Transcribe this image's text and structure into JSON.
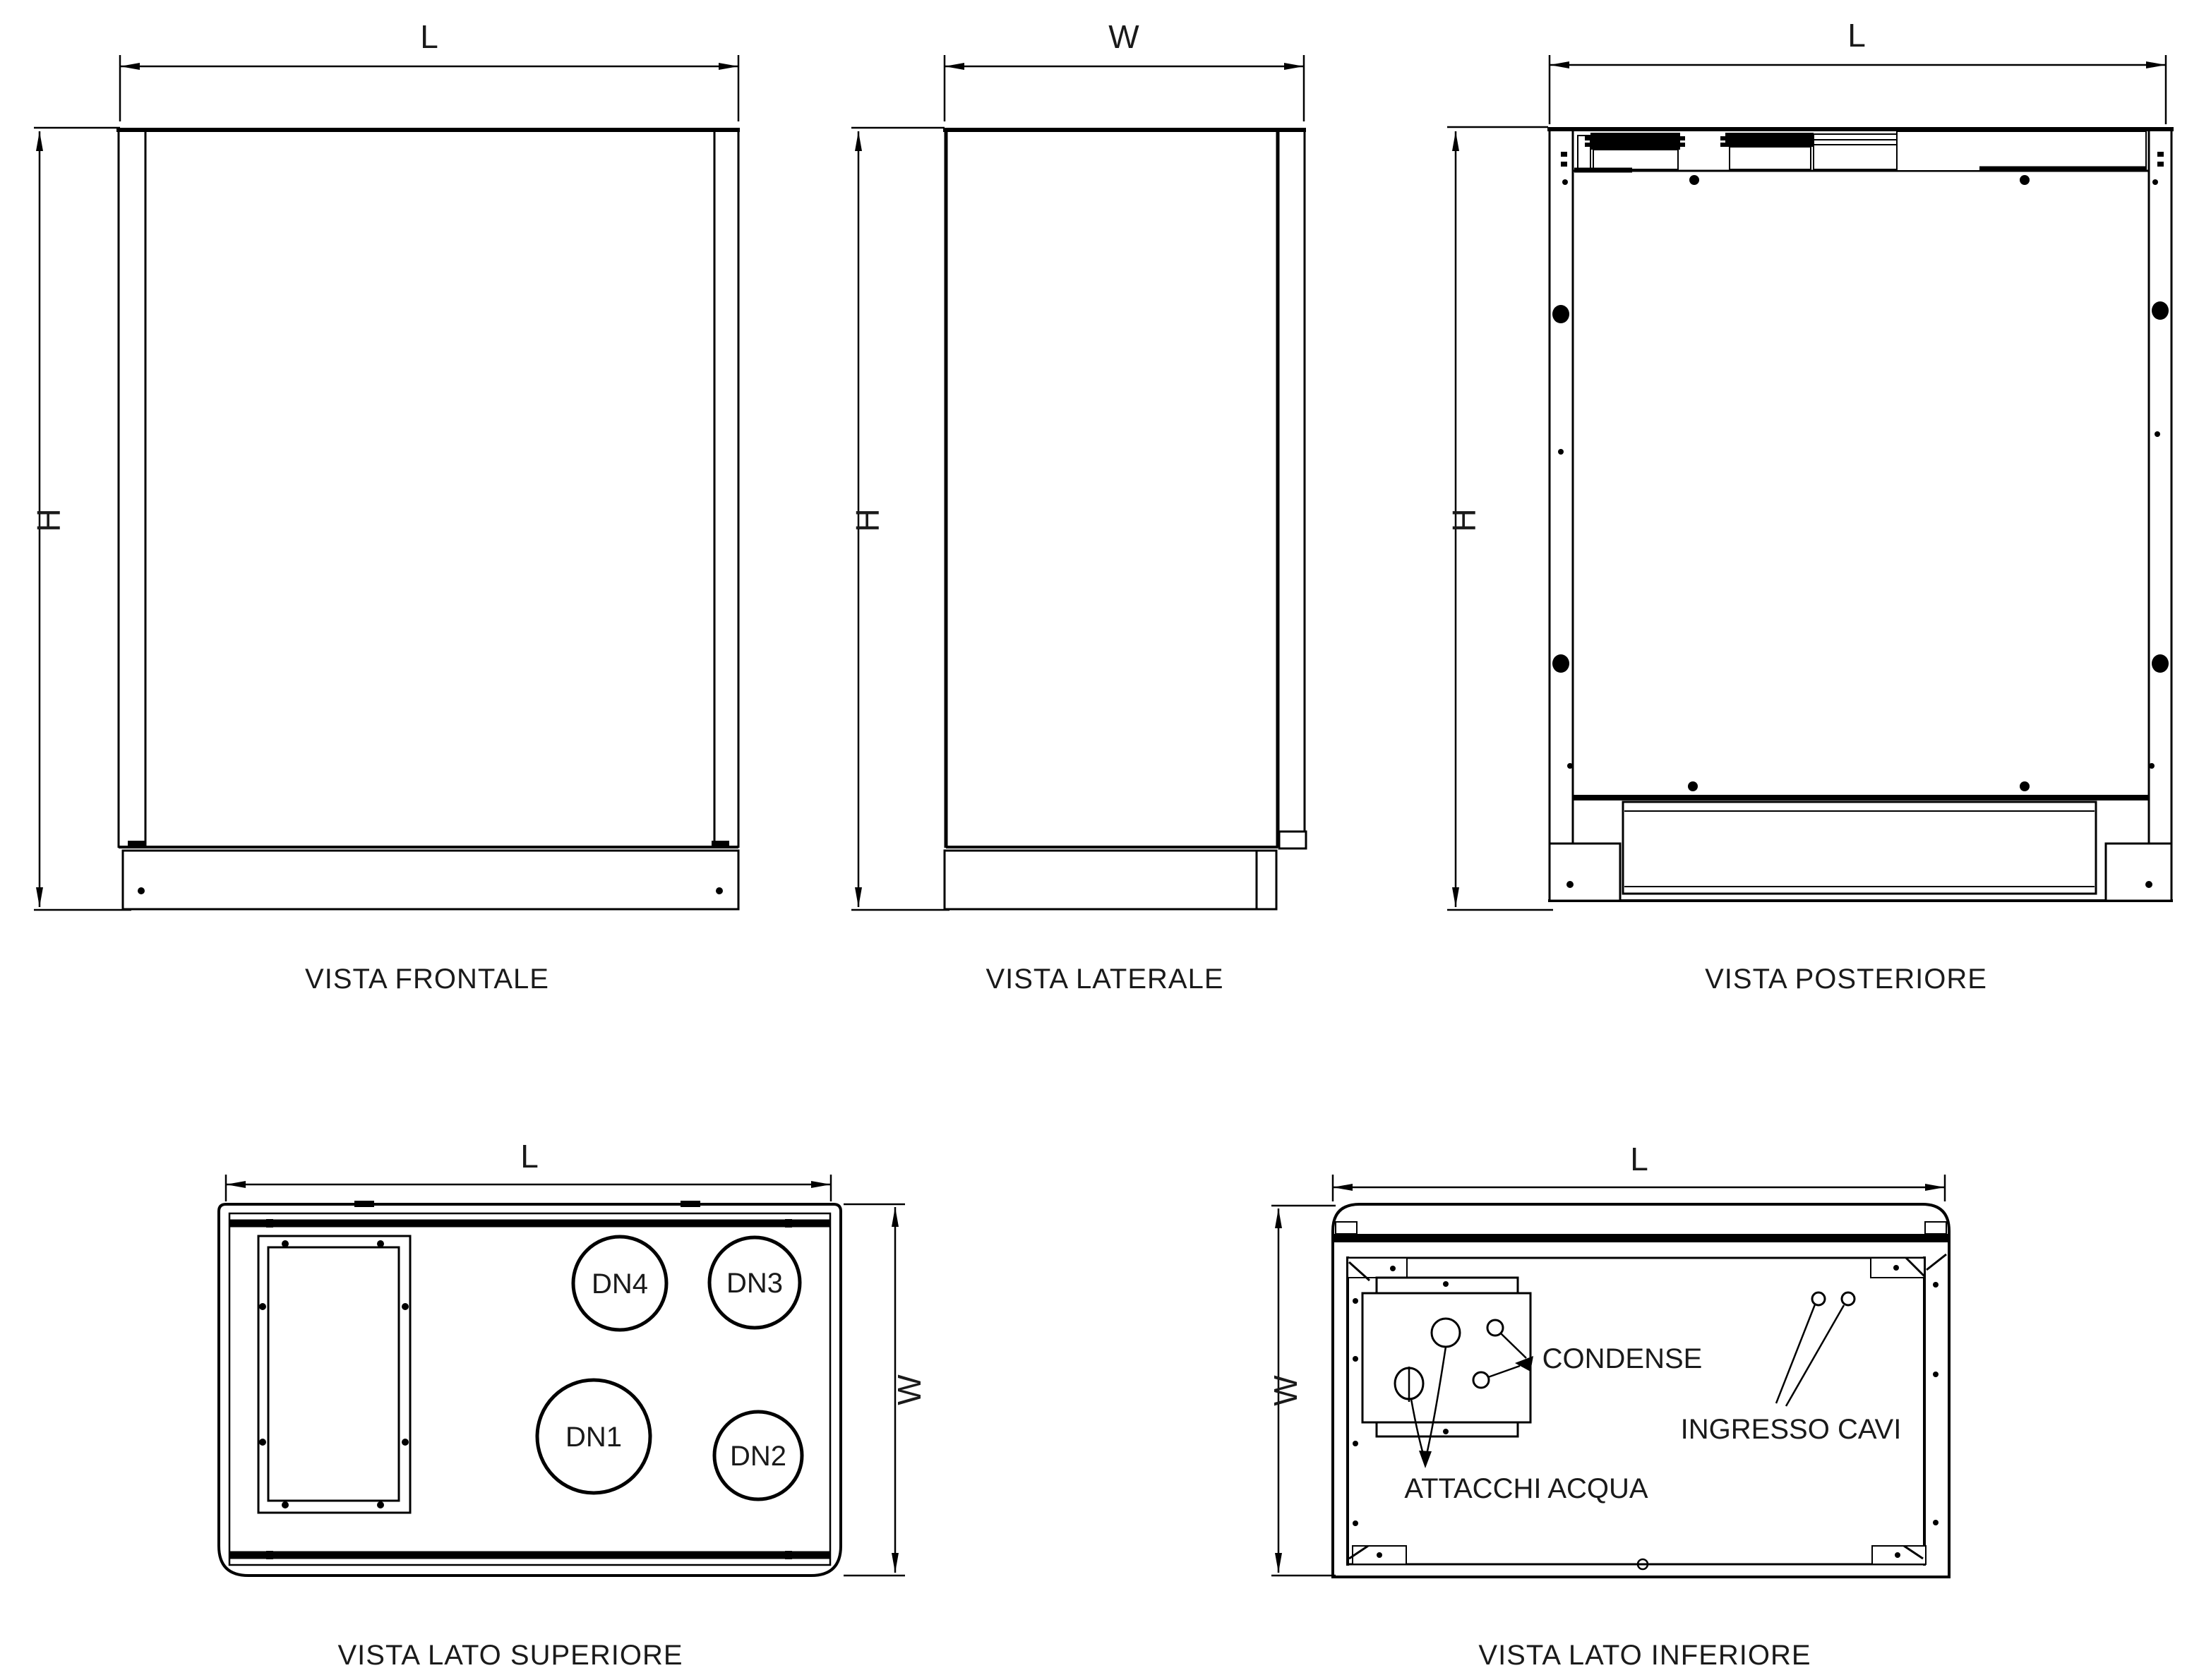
{
  "drawing": {
    "dims": {
      "length": "L",
      "width": "W",
      "height": "H"
    },
    "front": {
      "caption": "VISTA FRONTALE"
    },
    "side": {
      "caption": "VISTA LATERALE"
    },
    "rear": {
      "caption": "VISTA POSTERIORE"
    },
    "top": {
      "caption": "VISTA LATO SUPERIORE",
      "ports": {
        "dn1": "DN1",
        "dn2": "DN2",
        "dn3": "DN3",
        "dn4": "DN4"
      }
    },
    "bottom": {
      "caption": "VISTA LATO INFERIORE",
      "labels": {
        "condense": "CONDENSE",
        "cables": "INGRESSO CAVI",
        "water": "ATTACCHI ACQUA"
      }
    }
  },
  "colors": {
    "line": "#000000",
    "text": "#1a1a1a",
    "background": "#ffffff"
  }
}
